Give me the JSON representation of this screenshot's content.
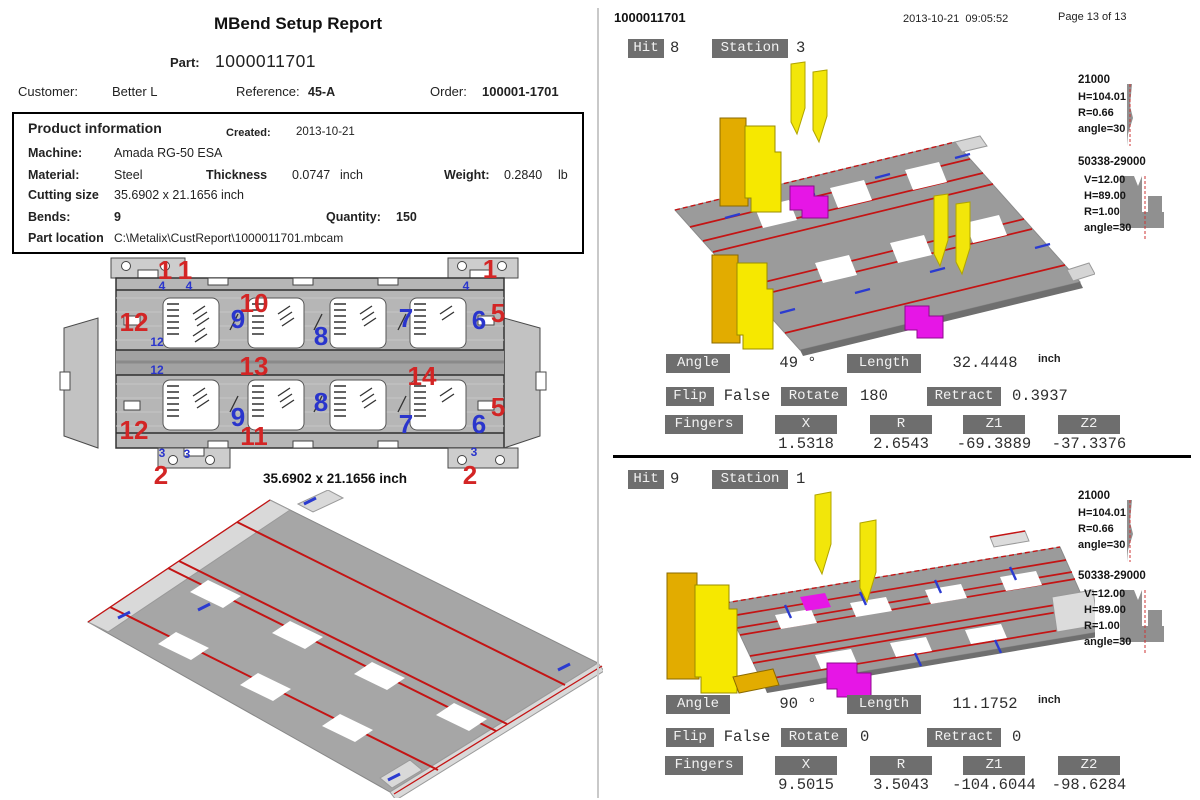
{
  "left": {
    "title": "MBend Setup Report",
    "part_label": "Part:",
    "part_value": "1000011701",
    "customer_label": "Customer:",
    "customer_value": "Better L",
    "reference_label": "Reference:",
    "reference_value": "45-A",
    "order_label": "Order:",
    "order_value": "100001-1701",
    "product_info": {
      "heading": "Product information",
      "created_label": "Created:",
      "created_value": "2013-10-21",
      "machine_label": "Machine:",
      "machine_value": "Amada RG-50 ESA",
      "material_label": "Material:",
      "material_value": "Steel",
      "thickness_label": "Thickness",
      "thickness_value": "0.0747",
      "thickness_unit": "inch",
      "weight_label": "Weight:",
      "weight_value": "0.2840",
      "weight_unit": "lb",
      "cutting_label": "Cutting size",
      "cutting_value": "35.6902 x 21.1656 inch",
      "bends_label": "Bends:",
      "bends_value": "9",
      "quantity_label": "Quantity:",
      "quantity_value": "150",
      "location_label": "Part location",
      "location_value": "C:\\Metalix\\CustReport\\1000011701.mbcam"
    },
    "flat_size_label": "35.6902 x 21.1656 inch",
    "flat_annotations": [
      {
        "t": "1",
        "c": "red",
        "s": "lg",
        "x": 107,
        "y": 14
      },
      {
        "t": "1",
        "c": "red",
        "s": "lg",
        "x": 127,
        "y": 14
      },
      {
        "t": "1",
        "c": "red",
        "s": "lg",
        "x": 432,
        "y": 13
      },
      {
        "t": "4",
        "c": "blue",
        "s": "sm",
        "x": 104,
        "y": 30
      },
      {
        "t": "4",
        "c": "blue",
        "s": "sm",
        "x": 131,
        "y": 30
      },
      {
        "t": "4",
        "c": "blue",
        "s": "sm",
        "x": 408,
        "y": 30
      },
      {
        "t": "10",
        "c": "red",
        "s": "lg",
        "x": 196,
        "y": 47
      },
      {
        "t": "12",
        "c": "red",
        "s": "lg",
        "x": 76,
        "y": 66
      },
      {
        "t": "9",
        "c": "blue",
        "s": "lg",
        "x": 180,
        "y": 63
      },
      {
        "t": "8",
        "c": "blue",
        "s": "lg",
        "x": 263,
        "y": 80
      },
      {
        "t": "7",
        "c": "blue",
        "s": "lg",
        "x": 348,
        "y": 62
      },
      {
        "t": "6",
        "c": "blue",
        "s": "lg",
        "x": 421,
        "y": 64
      },
      {
        "t": "5",
        "c": "red",
        "s": "lg",
        "x": 440,
        "y": 57
      },
      {
        "t": "12",
        "c": "blue",
        "s": "sm",
        "x": 99,
        "y": 86
      },
      {
        "t": "13",
        "c": "red",
        "s": "lg",
        "x": 196,
        "y": 110
      },
      {
        "t": "14",
        "c": "red",
        "s": "lg",
        "x": 364,
        "y": 120
      },
      {
        "t": "12",
        "c": "blue",
        "s": "sm",
        "x": 99,
        "y": 114
      },
      {
        "t": "9",
        "c": "blue",
        "s": "lg",
        "x": 180,
        "y": 161
      },
      {
        "t": "8",
        "c": "blue",
        "s": "lg",
        "x": 263,
        "y": 146
      },
      {
        "t": "7",
        "c": "blue",
        "s": "lg",
        "x": 348,
        "y": 168
      },
      {
        "t": "6",
        "c": "blue",
        "s": "lg",
        "x": 421,
        "y": 168
      },
      {
        "t": "5",
        "c": "red",
        "s": "lg",
        "x": 440,
        "y": 151
      },
      {
        "t": "12",
        "c": "red",
        "s": "lg",
        "x": 76,
        "y": 174
      },
      {
        "t": "11",
        "c": "red",
        "s": "lg",
        "x": 196,
        "y": 180
      },
      {
        "t": "3",
        "c": "blue",
        "s": "sm",
        "x": 104,
        "y": 197
      },
      {
        "t": "3",
        "c": "blue",
        "s": "sm",
        "x": 129,
        "y": 198
      },
      {
        "t": "3",
        "c": "blue",
        "s": "sm",
        "x": 416,
        "y": 196
      },
      {
        "t": "2",
        "c": "red",
        "s": "lg",
        "x": 103,
        "y": 219
      },
      {
        "t": "2",
        "c": "red",
        "s": "lg",
        "x": 412,
        "y": 219
      }
    ]
  },
  "right": {
    "header": {
      "part": "1000011701",
      "datetime": "2013-10-21  09:05:52",
      "page": "Page 13 of 13"
    },
    "panels": [
      {
        "hit_label": "Hit",
        "hit_value": "8",
        "station_label": "Station",
        "station_value": "3",
        "punch": {
          "name": "21000",
          "lines": [
            "H=104.01",
            "R=0.66",
            "angle=30"
          ]
        },
        "die": {
          "name": "50338-29000",
          "lines": [
            "V=12.00",
            "H=89.00",
            "R=1.00",
            "angle=30"
          ]
        },
        "angle_label": "Angle",
        "angle_value": "49 °",
        "length_label": "Length",
        "length_value": "32.4448",
        "length_unit": "inch",
        "flip_label": "Flip",
        "flip_value": "False",
        "rotate_label": "Rotate",
        "rotate_value": "180",
        "retract_label": "Retract",
        "retract_value": "0.3937",
        "fingers_label": "Fingers",
        "col_x": "X",
        "col_r": "R",
        "col_z1": "Z1",
        "col_z2": "Z2",
        "val_x": "1.5318",
        "val_r": "2.6543",
        "val_z1": "-69.3889",
        "val_z2": "-37.3376"
      },
      {
        "hit_label": "Hit",
        "hit_value": "9",
        "station_label": "Station",
        "station_value": "1",
        "punch": {
          "name": "21000",
          "lines": [
            "H=104.01",
            "R=0.66",
            "angle=30"
          ]
        },
        "die": {
          "name": "50338-29000",
          "lines": [
            "V=12.00",
            "H=89.00",
            "R=1.00",
            "angle=30"
          ]
        },
        "angle_label": "Angle",
        "angle_value": "90 °",
        "length_label": "Length",
        "length_value": "11.1752",
        "length_unit": "inch",
        "flip_label": "Flip",
        "flip_value": "False",
        "rotate_label": "Rotate",
        "rotate_value": "0",
        "retract_label": "Retract",
        "retract_value": "0",
        "fingers_label": "Fingers",
        "col_x": "X",
        "col_r": "R",
        "col_z1": "Z1",
        "col_z2": "Z2",
        "val_x": "9.5015",
        "val_r": "3.5043",
        "val_z1": "-104.6044",
        "val_z2": "-98.6284"
      }
    ]
  },
  "colors": {
    "label_box_bg": "#6e6e6e",
    "annotation_red": "#d32525",
    "annotation_blue": "#2a35cc",
    "bend_line_red": "#c41414",
    "finger_yellow": "#f6e800",
    "finger_gold": "#e2ac00",
    "clamp_magenta": "#e616e6",
    "sheet_gray": "#9b9b9b"
  }
}
